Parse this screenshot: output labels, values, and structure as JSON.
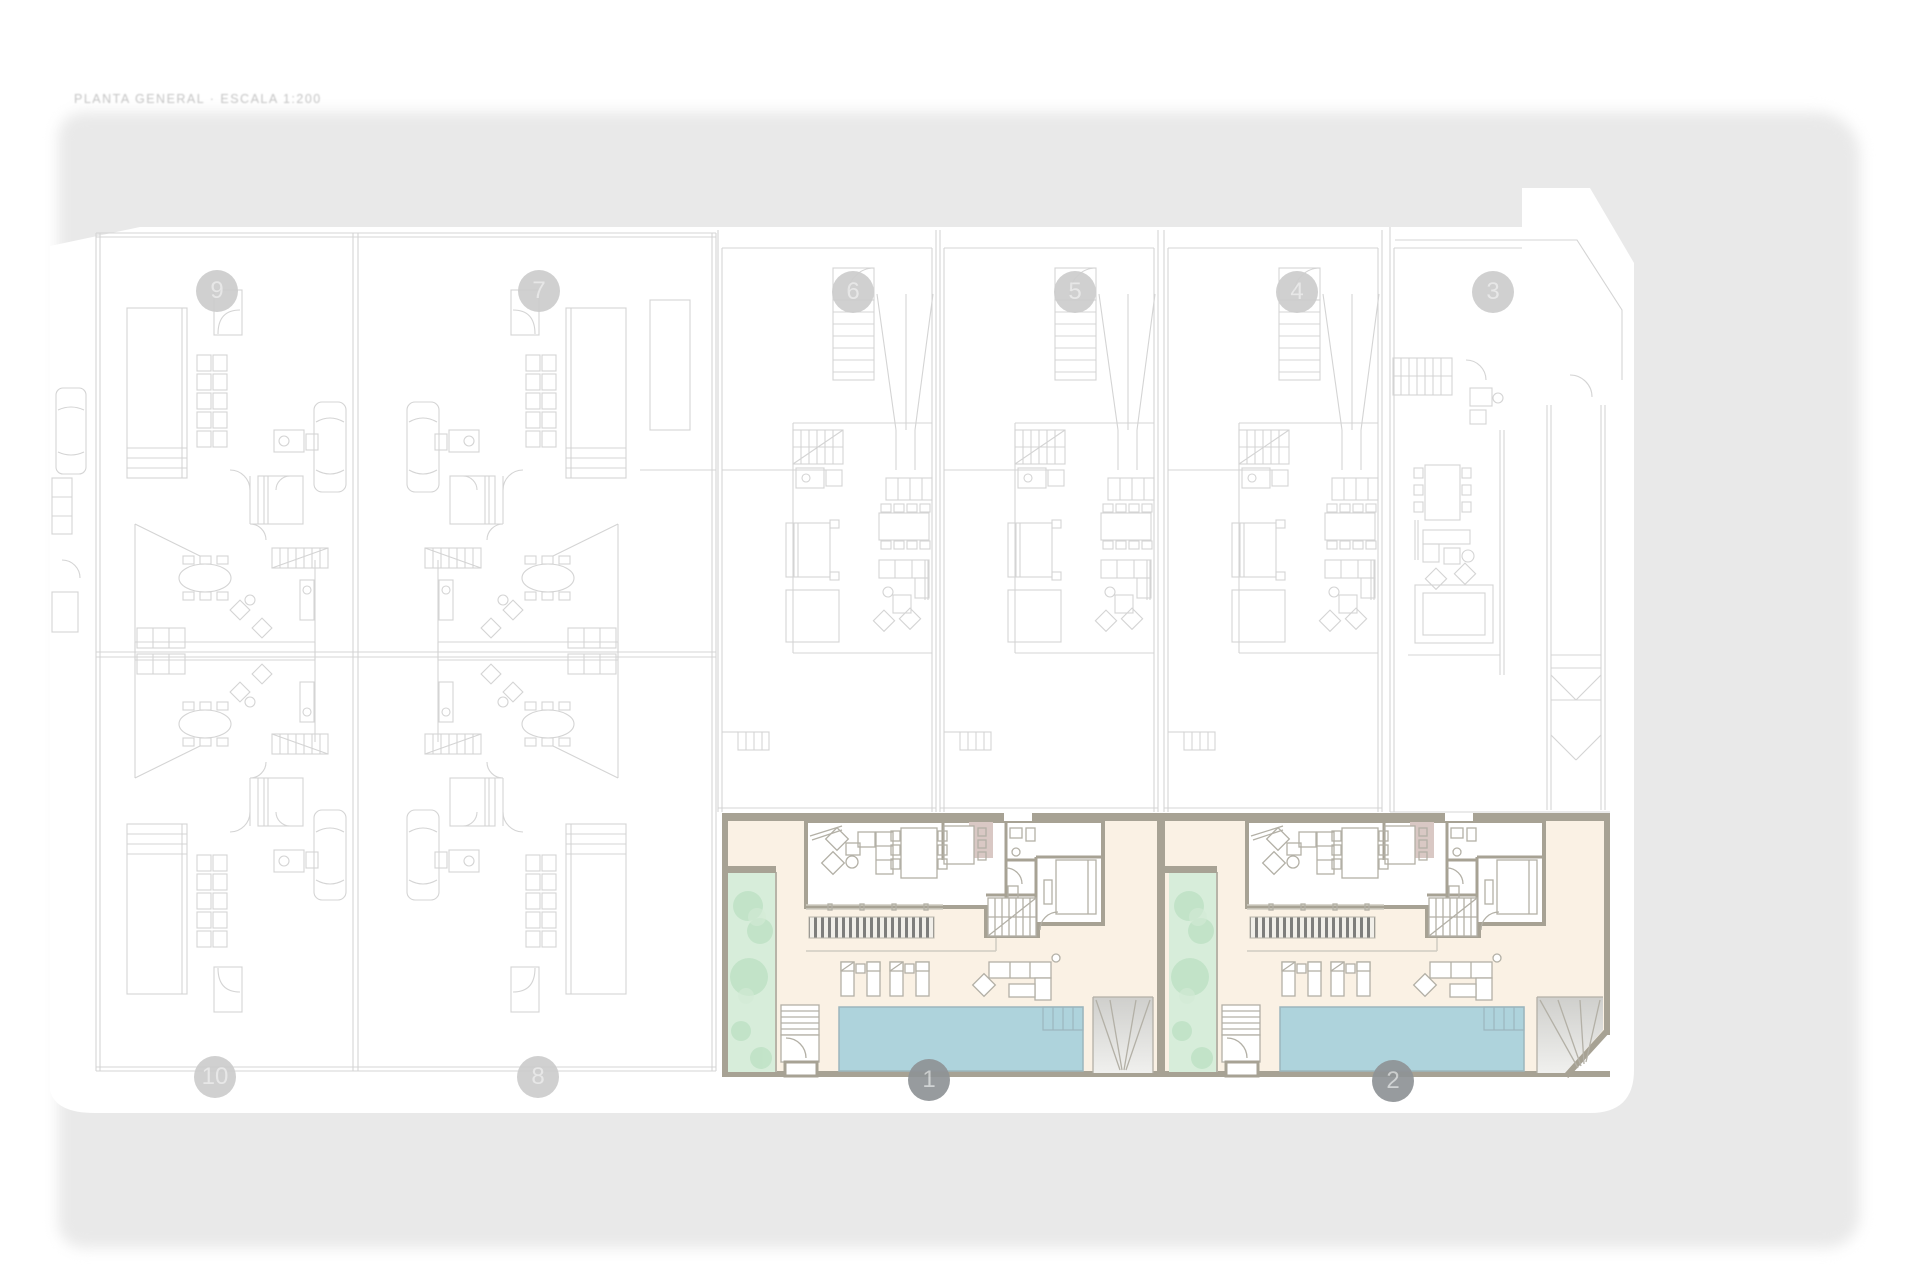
{
  "title": {
    "text": "PLANTA GENERAL · ESCALA 1:200"
  },
  "markers": [
    {
      "number": "9",
      "row": "top",
      "style": "light"
    },
    {
      "number": "7",
      "row": "top",
      "style": "light"
    },
    {
      "number": "6",
      "row": "top",
      "style": "light"
    },
    {
      "number": "5",
      "row": "top",
      "style": "light"
    },
    {
      "number": "4",
      "row": "top",
      "style": "light"
    },
    {
      "number": "3",
      "row": "top",
      "style": "light"
    },
    {
      "number": "10",
      "row": "bottom",
      "style": "light"
    },
    {
      "number": "8",
      "row": "bottom",
      "style": "light"
    },
    {
      "number": "1",
      "row": "bottom",
      "style": "dark",
      "highlighted": true
    },
    {
      "number": "2",
      "row": "bottom",
      "style": "dark",
      "highlighted": true
    }
  ],
  "highlighted_units": [
    {
      "label": "1"
    },
    {
      "label": "2"
    }
  ],
  "colors": {
    "pageBg": "#ffffff",
    "context": "#e9e9e9",
    "faded": "#d4d4d4",
    "cream": "#faf1e4",
    "wall": "#a7a294",
    "pool": "#aed3dc",
    "garden": "#d7edda",
    "tree": "#bfe2c6",
    "accent": "#d9c8c4",
    "deckStripe": "#7e7e7c",
    "markerLight": "#cdcdcd",
    "markerDark": "#8f9396"
  }
}
